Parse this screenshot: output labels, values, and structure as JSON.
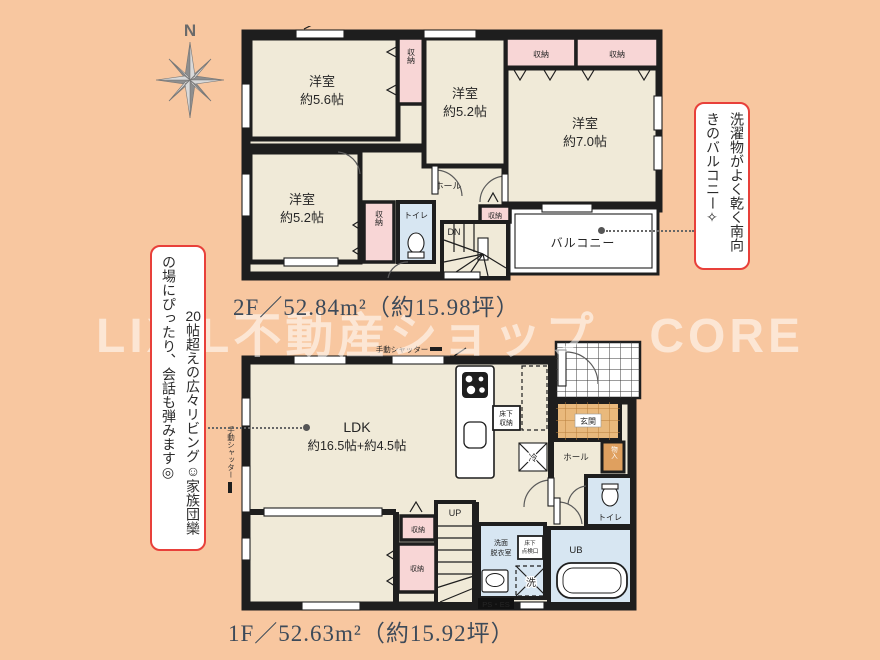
{
  "compass": {
    "label": "N"
  },
  "watermark": {
    "text": "LIXIL不動産ショップ　CORE"
  },
  "floor2": {
    "caption": "2F／52.84m²（約15.98坪）",
    "rooms": {
      "r56": {
        "name": "洋室",
        "size": "約5.6帖"
      },
      "r52a": {
        "name": "洋室",
        "size": "約5.2帖"
      },
      "r70": {
        "name": "洋室",
        "size": "約7.0帖"
      },
      "r52b": {
        "name": "洋室",
        "size": "約5.2帖"
      }
    },
    "labels": {
      "closet": "収納",
      "toilet": "トイレ",
      "hall": "ホール",
      "dn": "DN",
      "balcony": "バルコニー"
    }
  },
  "floor1": {
    "caption": "1F／52.63m²（約15.92坪）",
    "ldk": {
      "name": "LDK",
      "size": "約16.5帖+約4.5帖"
    },
    "labels": {
      "genkan": "玄関",
      "hall": "ホール",
      "toilet": "トイレ",
      "up": "UP",
      "closet": "収納",
      "monoire": "物入",
      "underfloor_storage_l1": "床下",
      "underfloor_storage_l2": "収納",
      "hatch_l1": "床下",
      "hatch_l2": "点検口",
      "washroom_l1": "洗面",
      "washroom_l2": "脱衣室",
      "ub": "UB",
      "wash": "洗",
      "fridge": "冷",
      "ps": "PS・ES",
      "shutter": "手動シャッター"
    }
  },
  "annotations": {
    "left": {
      "number": "20",
      "text": "帖超えの広々リビング☺家族団欒の場にぴったり、会話も弾みます◎"
    },
    "right": {
      "text": "洗濯物がよく乾く南向きのバルコニー✧"
    }
  }
}
